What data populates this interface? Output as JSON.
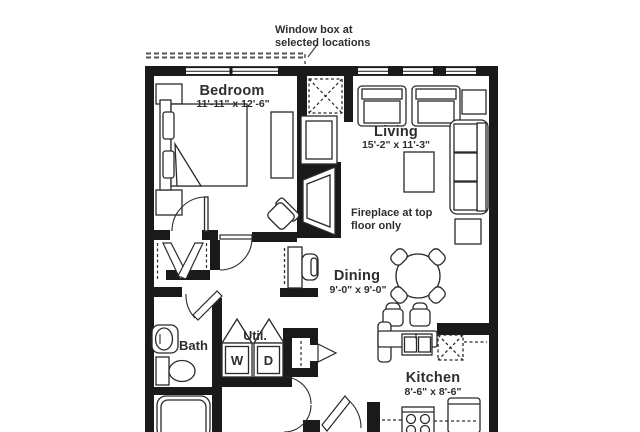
{
  "annotation": {
    "line1": "Window box at",
    "line2": "selected locations"
  },
  "rooms": {
    "bedroom": {
      "name": "Bedroom",
      "dims": "11'-11\" x 12'-6\""
    },
    "living": {
      "name": "Living",
      "dims": "15'-2\" x 11'-3\""
    },
    "dining": {
      "name": "Dining",
      "dims": "9'-0\" x 9'-0\""
    },
    "kitchen": {
      "name": "Kitchen",
      "dims": "8'-6\" x 8'-6\""
    },
    "bath": {
      "name": "Bath"
    },
    "utility": {
      "name": "Util.",
      "washer": "W",
      "dryer": "D"
    }
  },
  "notes": {
    "fireplace": {
      "line1": "Fireplace at top",
      "line2": "floor only"
    }
  },
  "colors": {
    "wall": "#1a1a1a",
    "line": "#2a2a2a",
    "text": "#2e2e2e",
    "background": "#ffffff"
  }
}
